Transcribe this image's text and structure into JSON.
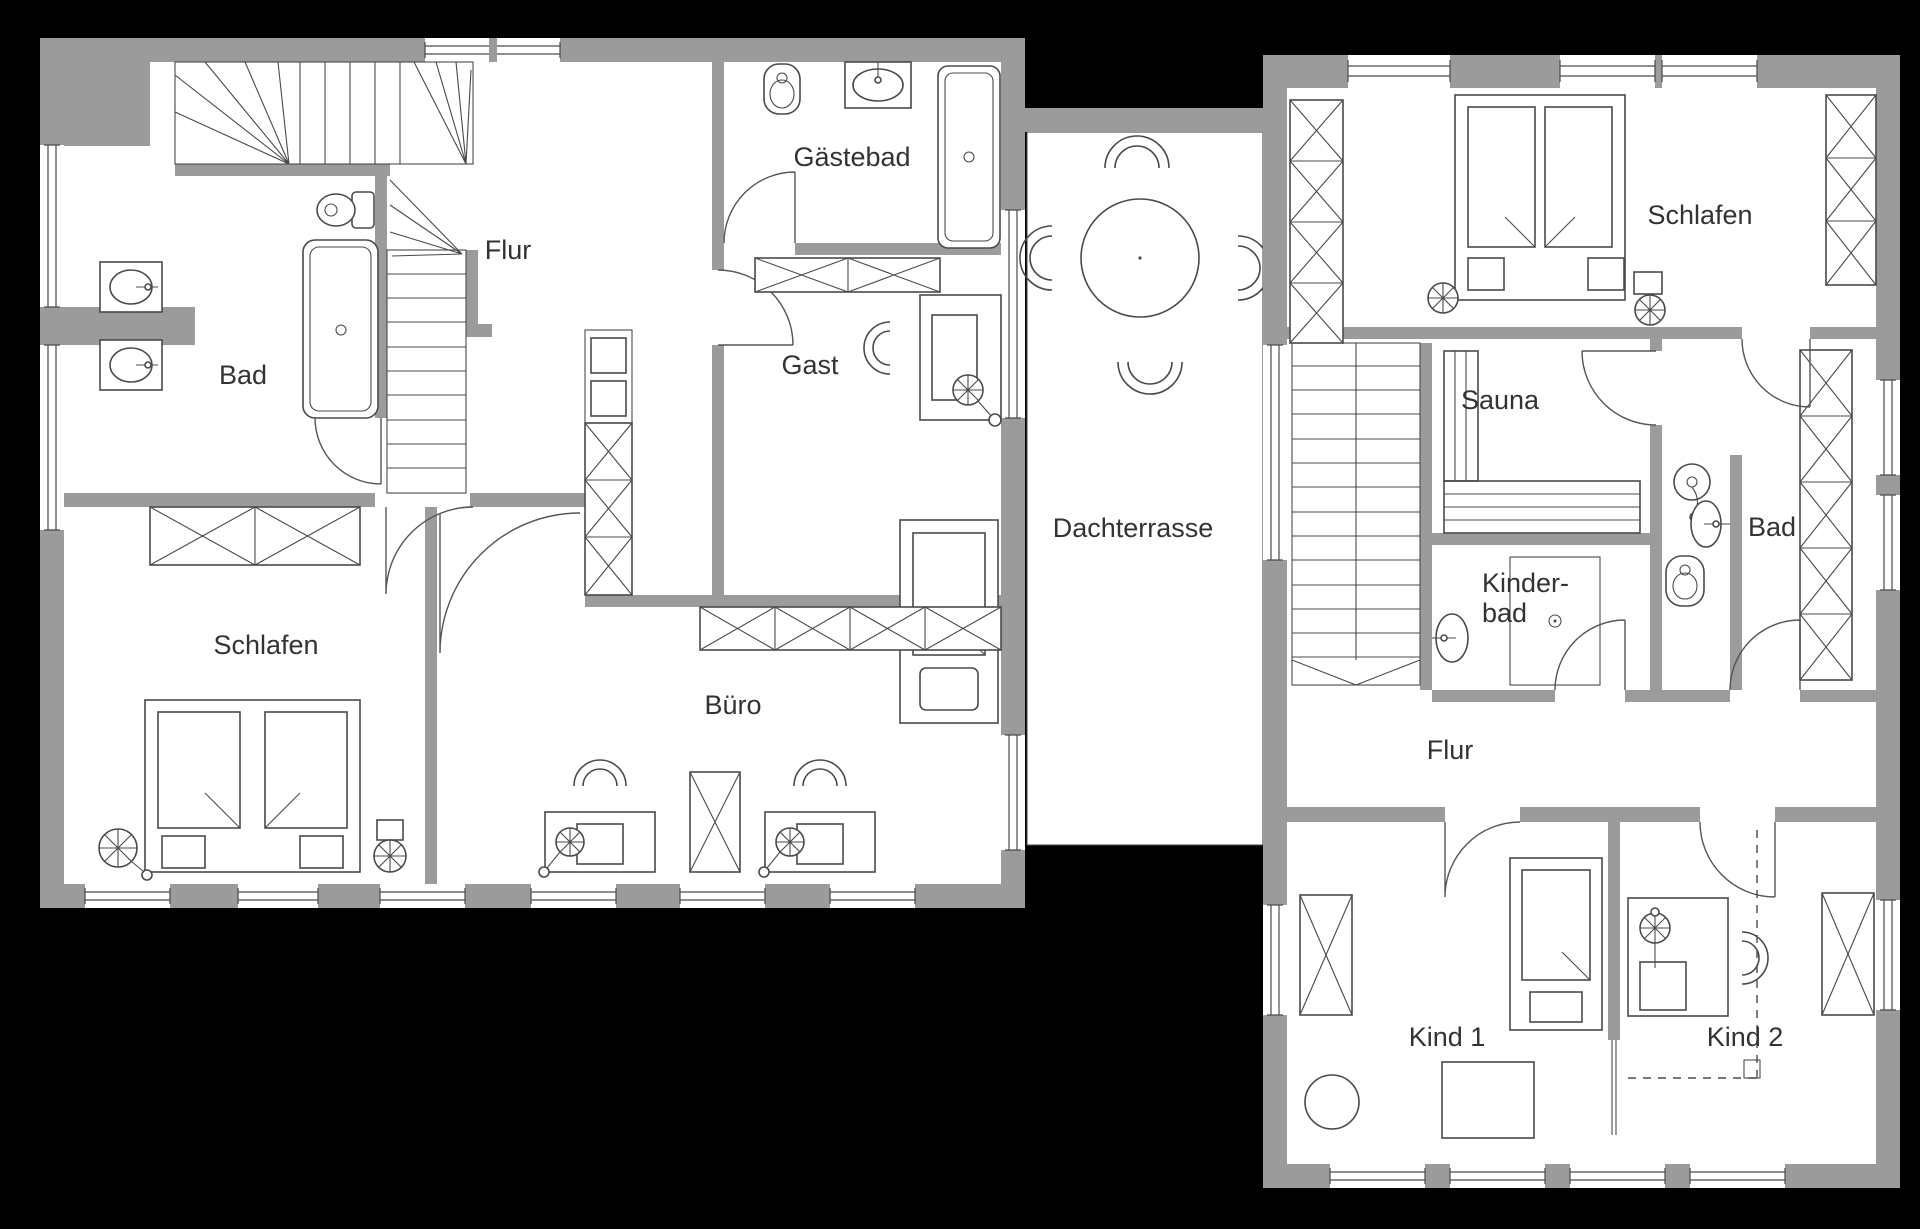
{
  "plan_type": "floor-plan",
  "colors": {
    "background": "#000000",
    "wall_gray": "#9b9b9b",
    "floor_white": "#ffffff",
    "line_dark": "#4a4a4a",
    "text": "#333333"
  },
  "floor_plan": {
    "left_building": {
      "rooms": [
        {
          "id": "flur",
          "label": "Flur"
        },
        {
          "id": "bad",
          "label": "Bad"
        },
        {
          "id": "gaestebad",
          "label": "Gästebad"
        },
        {
          "id": "gast",
          "label": "Gast"
        },
        {
          "id": "schlafen",
          "label": "Schlafen"
        },
        {
          "id": "buero",
          "label": "Büro"
        }
      ]
    },
    "terrace": {
      "label": "Dachterrasse"
    },
    "right_building": {
      "rooms": [
        {
          "id": "schlafen",
          "label": "Schlafen"
        },
        {
          "id": "sauna",
          "label": "Sauna"
        },
        {
          "id": "bad",
          "label": "Bad"
        },
        {
          "id": "kinderbad",
          "label_line1": "Kinder-",
          "label_line2": "bad"
        },
        {
          "id": "flur",
          "label": "Flur"
        },
        {
          "id": "kind1",
          "label": "Kind 1"
        },
        {
          "id": "kind2",
          "label": "Kind 2"
        }
      ]
    }
  }
}
